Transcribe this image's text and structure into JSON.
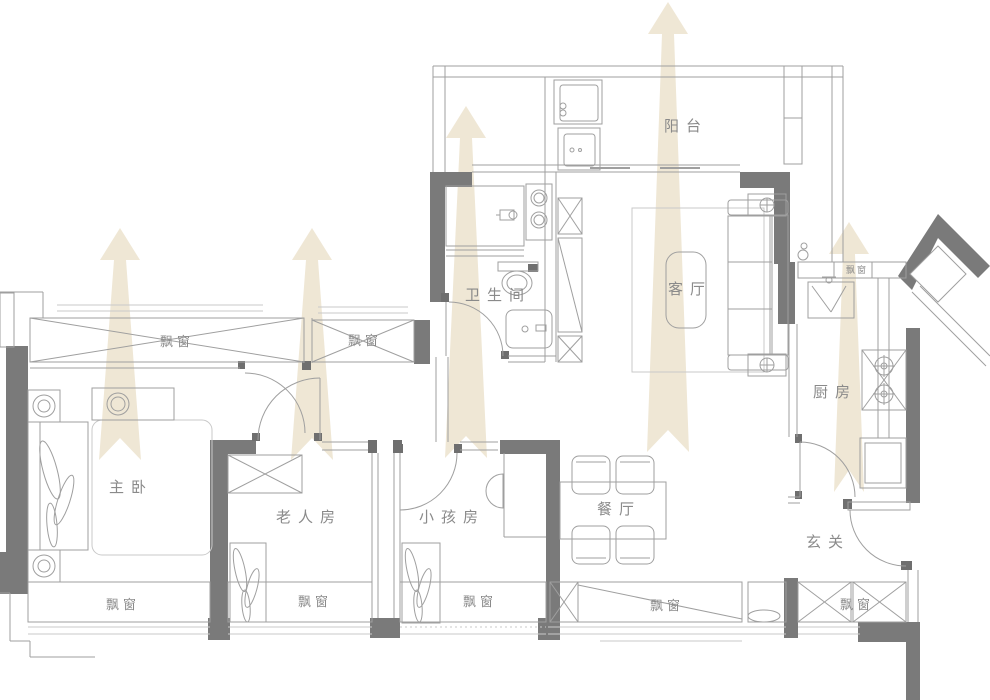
{
  "colors": {
    "bg": "#ffffff",
    "wall": "#7a7a7a",
    "wall-dark": "#6f6f6f",
    "line": "#9f9f9f",
    "line-light": "#c9c9c9",
    "text": "#8a8a8a",
    "arrow": "#efe7d5"
  },
  "labels": {
    "balcony": "阳台",
    "living_room": "客厅",
    "bathroom": "卫生间",
    "master_bedroom": "主卧",
    "elder_room": "老人房",
    "kids_room": "小孩房",
    "dining_room": "餐厅",
    "kitchen": "厨房",
    "entryway": "玄关",
    "bay_window": "飘窗"
  },
  "airflow": {
    "direction": "up",
    "arrow_count": 5
  }
}
